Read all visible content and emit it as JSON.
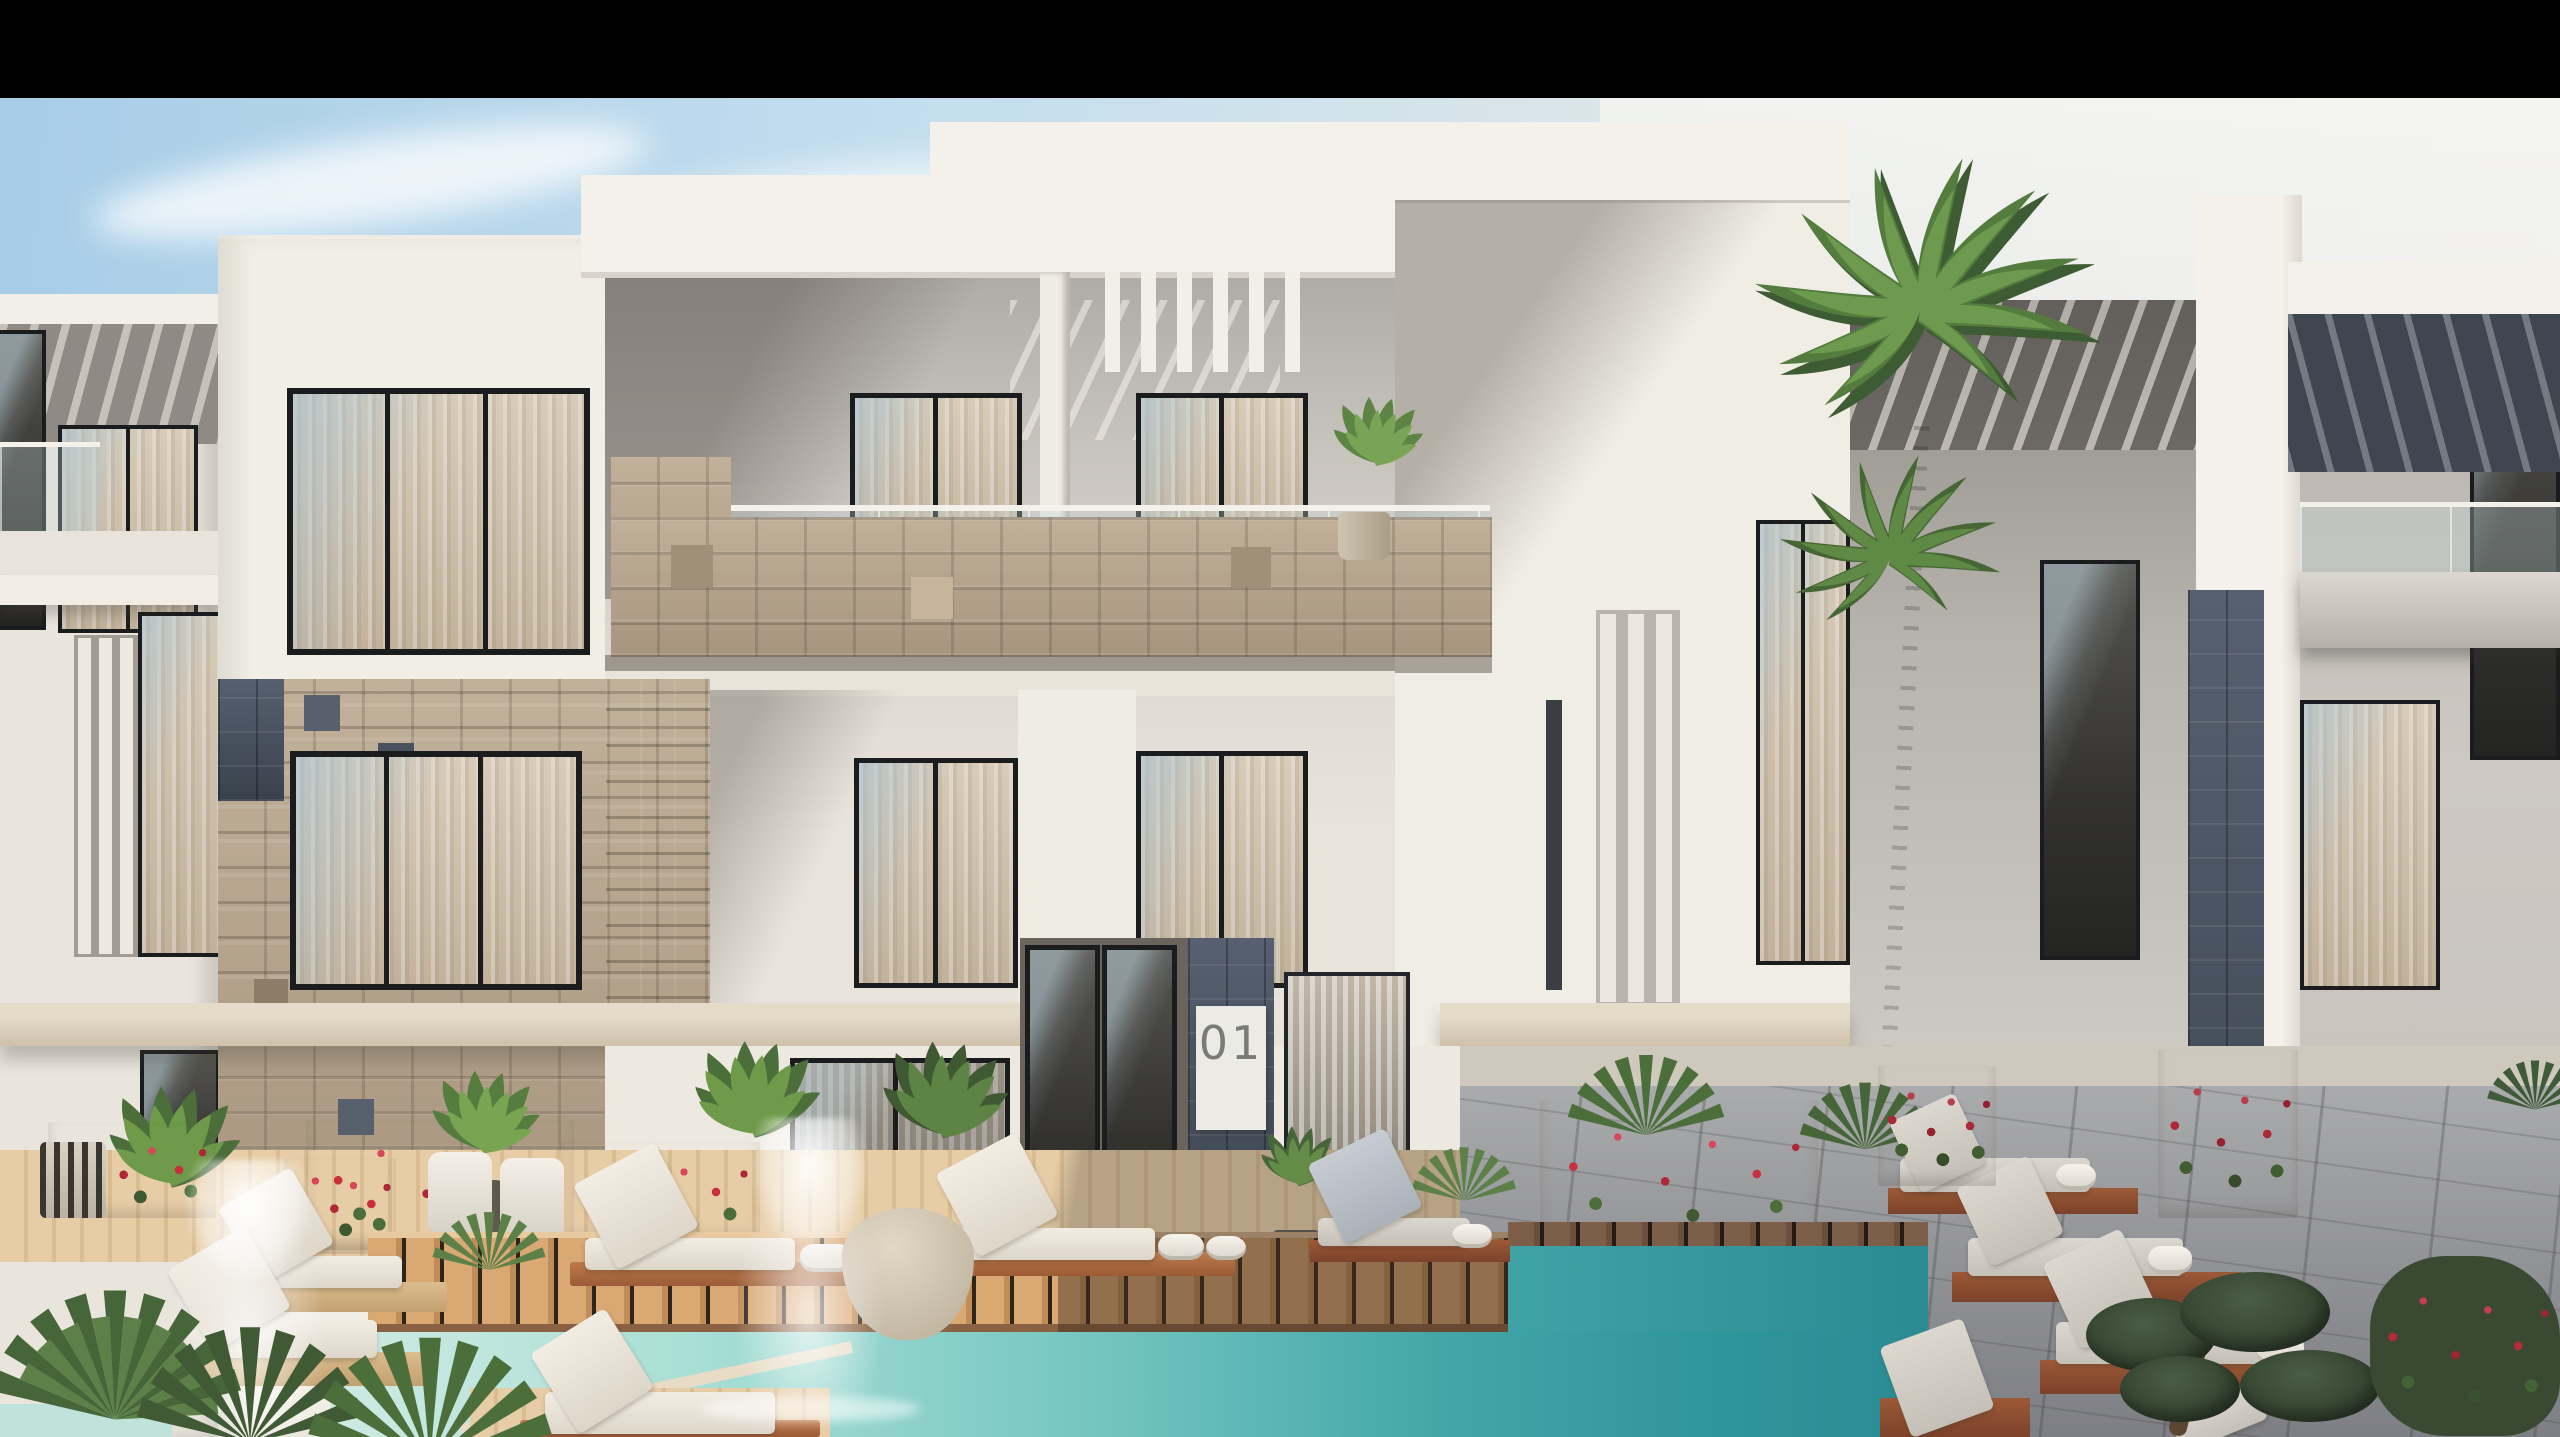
{
  "scene": {
    "description": "Photorealistic architectural rendering of a modern three-storey white residential complex with stone accents, balconies, a turquoise pool, wooden decks, sun loungers and tropical plants; black letterbox bar at top",
    "sign": {
      "text": "01"
    },
    "palette": {
      "letterbox": "#000000",
      "sky_blue": "#a7cde7",
      "sky_haze": "#efedea",
      "facade_light": "#f1eee7",
      "facade_shadow": "#c7c4bf",
      "slab_beige": "#cdbfab",
      "travertine": "#b3a28c",
      "slate_stone": "#49525e",
      "window_frame": "#1b1c1d",
      "glass_reflection": "#a4c1d1",
      "curtain_beige": "#cfc1ae",
      "pool_light": "#cfeae2",
      "pool_teal": "#2f9aa0",
      "deck_sun": "#d9a873",
      "deck_shade": "#7d5f49",
      "paving_shade": "#9da0a2",
      "lounger_wood": "#b06a42",
      "cushion_white": "#efe9e0",
      "towel_white": "#f1ede6",
      "plant_green": "#4f7342",
      "flower_red": "#c0303e"
    }
  }
}
